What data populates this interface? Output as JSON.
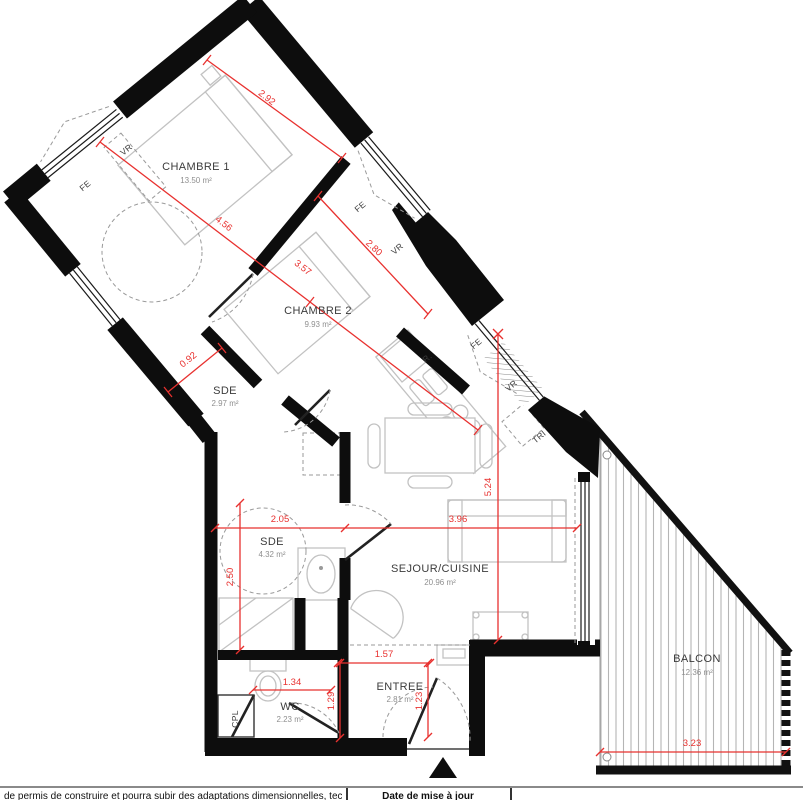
{
  "plan_title": "floor-plan",
  "rooms": {
    "chambre1": {
      "name": "CHAMBRE 1",
      "area": "13.50 m²"
    },
    "chambre2": {
      "name": "CHAMBRE 2",
      "area": "9.93 m²"
    },
    "sde1": {
      "name": "SDE",
      "area": "2.97 m²"
    },
    "sde2": {
      "name": "SDE",
      "area": "4.32 m²"
    },
    "sejour": {
      "name": "SEJOUR/CUISINE",
      "area": "20.96 m²"
    },
    "wc": {
      "name": "WC",
      "area": "2.23 m²"
    },
    "entree": {
      "name": "ENTREE",
      "area": "2.81 m²"
    },
    "balcon": {
      "name": "BALCON",
      "area": "12.36 m²"
    }
  },
  "dims": {
    "top1": "2.92",
    "top2": "4.56",
    "top3": "3.57",
    "top4": "2.80",
    "top5": "0.92",
    "mid1": "2.05",
    "mid2": "3.96",
    "mid3": "5.24",
    "mid4": "2.50",
    "low1": "1.57",
    "low2": "1.34",
    "low3": "1.29",
    "low4": "1.23",
    "bal1": "3.23"
  },
  "annotations": {
    "fe": "FE",
    "vr": "VR",
    "r": "R.",
    "tri": "TRI",
    "cpl": "CPL"
  },
  "footer": {
    "left": "de permis de construire et pourra subir des adaptations dimensionnelles, techniques et",
    "middle": "Date de mise à jour"
  },
  "colors": {
    "dimension_red": "#e8312f",
    "wall_black": "#0d0d0d",
    "furniture_gray": "#c2c2c2"
  }
}
